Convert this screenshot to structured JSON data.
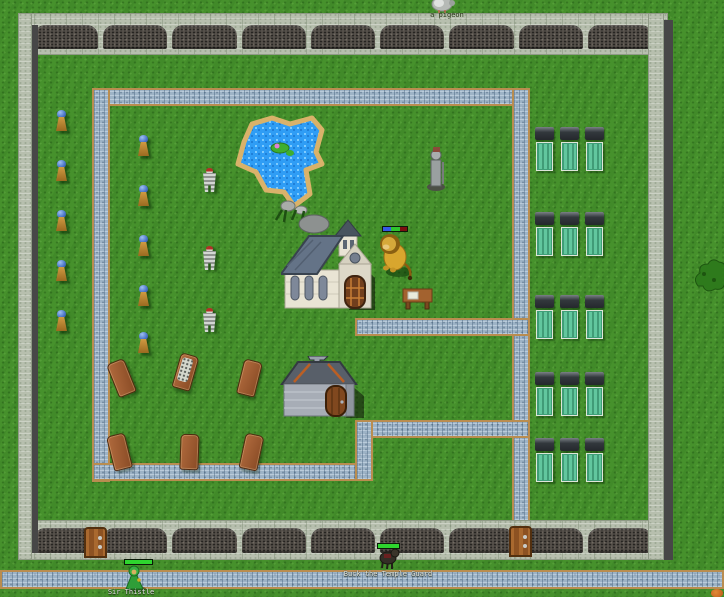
{
  "scene": {
    "title": "Walled temple courtyard - tile RPG overworld",
    "labels": {
      "top_creature_name": "a pigeon",
      "center_npc_name": "Buck the Temple Guard",
      "player_name": "Sir Thistle"
    },
    "wall": {
      "arches_top": 9,
      "arches_bottom": 9
    },
    "colors": {
      "grass": "#46912c",
      "wall_light_stone": "#b7bfae",
      "wall_dark_arch": "#55504a",
      "wall_shadow": "#474747",
      "path_cobble": "#9db3c6",
      "path_border": "#b98d50",
      "pond_water": "#2f9df5",
      "pond_sand": "#d9b26a",
      "bed_mattress": "#62c79e",
      "coffin_wood": "#9b5b38",
      "guard_helmet": "#4a74c8",
      "guard_tunic": "#c08a3a",
      "hp_green": "#2ed52e",
      "hp_blue": "#3558e8",
      "door_wood": "#9a5c28",
      "lion_gold": "#d8a62e"
    },
    "sprites": [
      {
        "type": "guard",
        "x": 55,
        "y": 110
      },
      {
        "type": "guard",
        "x": 55,
        "y": 160
      },
      {
        "type": "guard",
        "x": 55,
        "y": 210
      },
      {
        "type": "guard",
        "x": 55,
        "y": 260
      },
      {
        "type": "guard",
        "x": 55,
        "y": 310
      },
      {
        "type": "guard",
        "x": 137,
        "y": 135
      },
      {
        "type": "guard",
        "x": 137,
        "y": 185
      },
      {
        "type": "guard",
        "x": 137,
        "y": 235
      },
      {
        "type": "guard",
        "x": 137,
        "y": 285
      },
      {
        "type": "guard",
        "x": 137,
        "y": 332
      },
      {
        "type": "skeleton-warrior",
        "x": 202,
        "y": 168
      },
      {
        "type": "skeleton-warrior",
        "x": 202,
        "y": 246
      },
      {
        "type": "skeleton-warrior",
        "x": 202,
        "y": 308
      },
      {
        "type": "bed",
        "x": 534,
        "y": 127
      },
      {
        "type": "bed",
        "x": 559,
        "y": 127
      },
      {
        "type": "bed",
        "x": 584,
        "y": 127
      },
      {
        "type": "bed",
        "x": 534,
        "y": 212
      },
      {
        "type": "bed",
        "x": 559,
        "y": 212
      },
      {
        "type": "bed",
        "x": 584,
        "y": 212
      },
      {
        "type": "bed",
        "x": 534,
        "y": 295
      },
      {
        "type": "bed",
        "x": 559,
        "y": 295
      },
      {
        "type": "bed",
        "x": 584,
        "y": 295
      },
      {
        "type": "bed",
        "x": 534,
        "y": 372
      },
      {
        "type": "bed",
        "x": 559,
        "y": 372
      },
      {
        "type": "bed",
        "x": 584,
        "y": 372
      },
      {
        "type": "bed",
        "x": 534,
        "y": 438
      },
      {
        "type": "bed",
        "x": 559,
        "y": 438
      },
      {
        "type": "bed",
        "x": 584,
        "y": 438
      },
      {
        "type": "coffin",
        "x": 112,
        "y": 360,
        "rot": -22
      },
      {
        "type": "coffin-open",
        "x": 176,
        "y": 354,
        "rot": 16
      },
      {
        "type": "coffin",
        "x": 240,
        "y": 360,
        "rot": 14
      },
      {
        "type": "coffin",
        "x": 110,
        "y": 434,
        "rot": -14
      },
      {
        "type": "coffin",
        "x": 180,
        "y": 434,
        "rot": 2
      },
      {
        "type": "coffin",
        "x": 242,
        "y": 434,
        "rot": 12
      }
    ]
  }
}
